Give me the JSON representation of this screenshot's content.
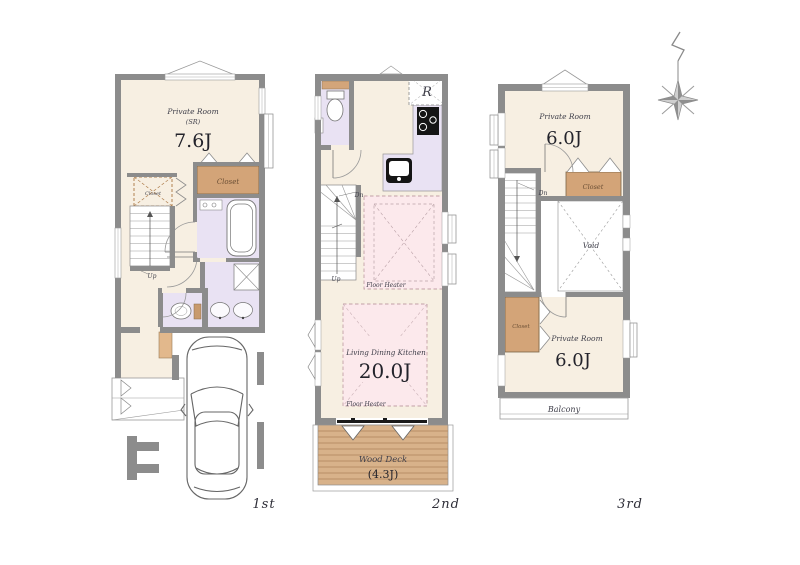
{
  "colors": {
    "wall": "#8c8c8c",
    "room_cream": "#f7efe2",
    "wet_lavender": "#e9e2f3",
    "closet_brown": "#d3a478",
    "heater_pink": "#fce9ec",
    "deck_brown": "#d8b28a",
    "text": "#3e3e49"
  },
  "floor1": {
    "label": "1st",
    "room_name": "Private Room",
    "room_sub": "(SR)",
    "room_size": "7.6J",
    "closet_small": "Closet",
    "closet_main": "Closet",
    "up": "Up"
  },
  "floor2": {
    "label": "2nd",
    "fridge": "R",
    "dn": "Dn",
    "up": "Up",
    "heater_upper": "Floor Heater",
    "ldk_name": "Living Dining Kitchen",
    "ldk_size": "20.0J",
    "heater_lower": "Floor Heater",
    "deck_name": "Wood Deck",
    "deck_size": "(4.3J)"
  },
  "floor3": {
    "label": "3rd",
    "room_top_name": "Private Room",
    "room_top_size": "6.0J",
    "closet_top": "Closet",
    "dn": "Dn",
    "void": "Void",
    "closet_left": "Closet",
    "room_bottom_name": "Private Room",
    "room_bottom_size": "6.0J",
    "balcony": "Balcony"
  },
  "icons": {
    "compass": "north-compass-icon",
    "car": "car-top-view-icon",
    "bathtub": "bathtub-icon",
    "toilet": "toilet-icon",
    "stove": "stove-icon",
    "sink": "kitchen-sink-icon"
  }
}
